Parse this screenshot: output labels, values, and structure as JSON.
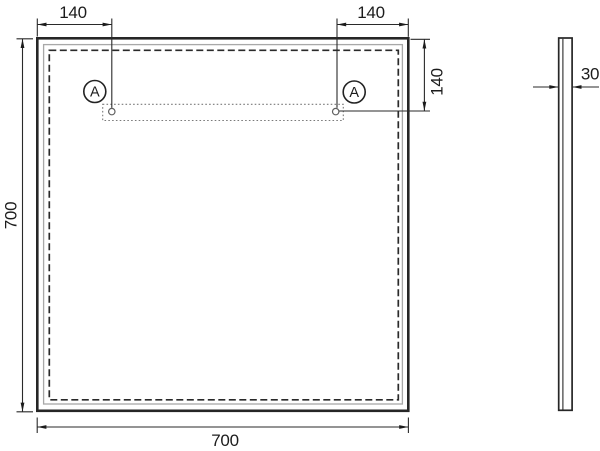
{
  "front_view": {
    "dim_offset_left": "140",
    "dim_offset_right": "140",
    "dim_offset_top": "140",
    "dim_height": "700",
    "dim_width": "700",
    "mount_marker_left": "A",
    "mount_marker_right": "A"
  },
  "side_view": {
    "dim_thickness": "30"
  },
  "colors": {
    "line": "#262626",
    "thin_line": "#2a2a2a",
    "inner_frame": "#a8a8a8",
    "bracket_dotted": "#7a7a7a",
    "text": "#1c1c1c",
    "background": "#ffffff"
  }
}
